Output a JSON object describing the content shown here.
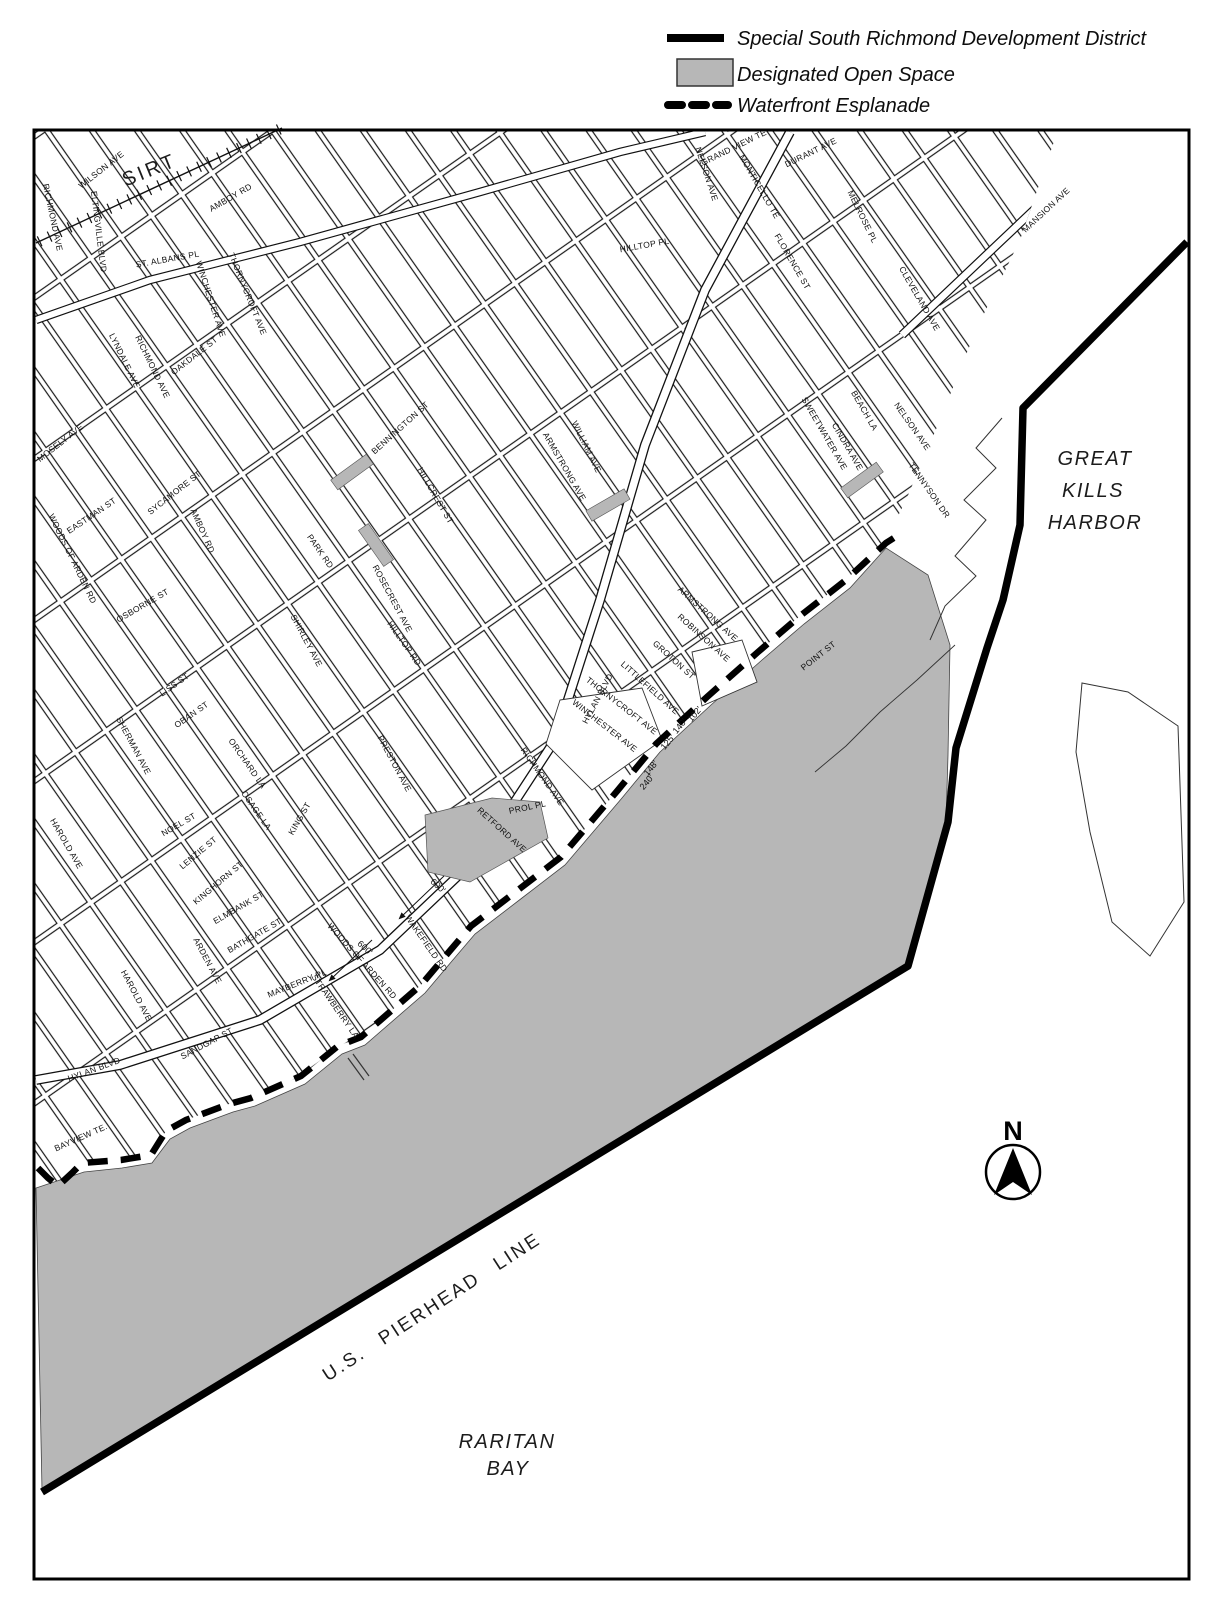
{
  "legend": {
    "items": [
      {
        "swatch": "solid-line",
        "label": "Special South Richmond Development District"
      },
      {
        "swatch": "gray-fill",
        "label": "Designated Open Space"
      },
      {
        "swatch": "dashed-line",
        "label": "Waterfront Esplanade"
      }
    ]
  },
  "map": {
    "colors": {
      "open_space": "#b7b7b7",
      "line": "#000000",
      "background": "#ffffff"
    },
    "region_labels": {
      "harbor": [
        "GREAT",
        "KILLS",
        "HARBOR"
      ],
      "bay": [
        "RARITAN",
        "BAY"
      ],
      "pierhead": "U.S. PIERHEAD LINE",
      "railroad": "SIRT",
      "compass": "N"
    },
    "street_labels": [
      {
        "t": "WILSON AVE",
        "x": 103,
        "y": 172,
        "r": -38
      },
      {
        "t": "RICHMOND AVE",
        "x": 50,
        "y": 218,
        "r": 78
      },
      {
        "t": "ELTINGVILLE BLVD",
        "x": 96,
        "y": 232,
        "r": 83
      },
      {
        "t": "AMBOY RD",
        "x": 232,
        "y": 200,
        "r": -30
      },
      {
        "t": "ST. ALBANS PL",
        "x": 168,
        "y": 262,
        "r": -10
      },
      {
        "t": "MOSELY AVE",
        "x": 62,
        "y": 445,
        "r": -38
      },
      {
        "t": "AMBOY RD",
        "x": 200,
        "y": 532,
        "r": 66
      },
      {
        "t": "LYNDALE AVE",
        "x": 122,
        "y": 362,
        "r": 64
      },
      {
        "t": "RICHMOND AVE",
        "x": 150,
        "y": 368,
        "r": 64
      },
      {
        "t": "THORNYCROFT AVE",
        "x": 245,
        "y": 295,
        "r": 68
      },
      {
        "t": "OAKDALE ST",
        "x": 196,
        "y": 358,
        "r": -38
      },
      {
        "t": "WINCHESTER AVE",
        "x": 208,
        "y": 300,
        "r": 72
      },
      {
        "t": "SYCAMORE ST",
        "x": 176,
        "y": 495,
        "r": -38
      },
      {
        "t": "EASTMAN ST",
        "x": 93,
        "y": 518,
        "r": -34
      },
      {
        "t": "WOODS OF ARDEN RD",
        "x": 70,
        "y": 560,
        "r": 64,
        "s": 10
      },
      {
        "t": "OSBORNE ST",
        "x": 144,
        "y": 608,
        "r": -30
      },
      {
        "t": "SHIRLEY AVE",
        "x": 304,
        "y": 642,
        "r": 62
      },
      {
        "t": "PARK RD",
        "x": 318,
        "y": 553,
        "r": 55
      },
      {
        "t": "BENNINGTON ST",
        "x": 402,
        "y": 430,
        "r": -42
      },
      {
        "t": "HILLCREST ST",
        "x": 433,
        "y": 497,
        "r": 60
      },
      {
        "t": "ARMSTRONG AVE",
        "x": 562,
        "y": 468,
        "r": 60
      },
      {
        "t": "WILLIAM AVE",
        "x": 584,
        "y": 448,
        "r": 64
      },
      {
        "t": "ROSECREST AVE",
        "x": 390,
        "y": 600,
        "r": 62
      },
      {
        "t": "HILLTOP RD",
        "x": 402,
        "y": 645,
        "r": 55
      },
      {
        "t": "HYLAN BLVD",
        "x": 600,
        "y": 700,
        "r": -62,
        "s": 13,
        "ls": 1
      },
      {
        "t": "HILLTOP PL",
        "x": 645,
        "y": 248,
        "r": -10
      },
      {
        "t": "NELSON AVE",
        "x": 704,
        "y": 175,
        "r": 72
      },
      {
        "t": "GRAND VIEW TE",
        "x": 735,
        "y": 150,
        "r": -26
      },
      {
        "t": "DURANT AVE",
        "x": 812,
        "y": 155,
        "r": -26
      },
      {
        "t": "MONTICELLO TE",
        "x": 757,
        "y": 188,
        "r": 60
      },
      {
        "t": "MELROSE PL",
        "x": 860,
        "y": 218,
        "r": 64
      },
      {
        "t": "FLORENCE ST",
        "x": 790,
        "y": 263,
        "r": 60
      },
      {
        "t": "CLEVELAND AVE",
        "x": 917,
        "y": 300,
        "r": 60
      },
      {
        "t": "MANSION AVE",
        "x": 1048,
        "y": 212,
        "r": -43,
        "s": 15,
        "ls": 4
      },
      {
        "t": "SWEETWATER AVE",
        "x": 822,
        "y": 435,
        "r": 60
      },
      {
        "t": "BEACH LA",
        "x": 862,
        "y": 412,
        "r": 60
      },
      {
        "t": "CINDRA AVE",
        "x": 845,
        "y": 448,
        "r": 60
      },
      {
        "t": "NELSON AVE",
        "x": 910,
        "y": 428,
        "r": 55
      },
      {
        "t": "TENNYSON DR",
        "x": 927,
        "y": 492,
        "r": 55
      },
      {
        "t": "POINT ST",
        "x": 820,
        "y": 658,
        "r": -38
      },
      {
        "t": "ROBINSON AVE",
        "x": 702,
        "y": 640,
        "r": 42
      },
      {
        "t": "GROTON ST",
        "x": 672,
        "y": 662,
        "r": 42
      },
      {
        "t": "LITTLEFIELD AVE",
        "x": 648,
        "y": 690,
        "r": 42
      },
      {
        "t": "ARMSTRONG AVE",
        "x": 706,
        "y": 616,
        "r": 42
      },
      {
        "t": "THORNYCROFT AVE",
        "x": 620,
        "y": 708,
        "r": 38
      },
      {
        "t": "WINCHESTER AVE",
        "x": 603,
        "y": 728,
        "r": 38
      },
      {
        "t": "RICHMOND AVE",
        "x": 540,
        "y": 778,
        "r": 55,
        "s": 11,
        "ls": 2
      },
      {
        "t": "PROL PL",
        "x": 528,
        "y": 810,
        "r": -12
      },
      {
        "t": "RETFORD AVE",
        "x": 500,
        "y": 832,
        "r": 42
      },
      {
        "t": "PRESTON AVE",
        "x": 392,
        "y": 765,
        "r": 62
      },
      {
        "t": "KING ST",
        "x": 302,
        "y": 820,
        "r": -60
      },
      {
        "t": "NOEL ST",
        "x": 180,
        "y": 827,
        "r": -30
      },
      {
        "t": "LENZIE ST",
        "x": 200,
        "y": 855,
        "r": -40
      },
      {
        "t": "KINGHORN ST",
        "x": 220,
        "y": 885,
        "r": -40
      },
      {
        "t": "ELMBANK ST",
        "x": 240,
        "y": 910,
        "r": -30
      },
      {
        "t": "BATHGATE ST",
        "x": 256,
        "y": 938,
        "r": -30
      },
      {
        "t": "ORCHARD LA",
        "x": 245,
        "y": 765,
        "r": 55
      },
      {
        "t": "OSAGE LA",
        "x": 254,
        "y": 812,
        "r": 55
      },
      {
        "t": "OBAN ST",
        "x": 193,
        "y": 717,
        "r": -35
      },
      {
        "t": "LISS ST",
        "x": 176,
        "y": 687,
        "r": -35
      },
      {
        "t": "SHERMAN AVE",
        "x": 131,
        "y": 747,
        "r": 62
      },
      {
        "t": "HAROLD AVE",
        "x": 64,
        "y": 845,
        "r": 60
      },
      {
        "t": "HAROLD AVE",
        "x": 134,
        "y": 997,
        "r": 62
      },
      {
        "t": "ARDEN AVE",
        "x": 205,
        "y": 962,
        "r": 62
      },
      {
        "t": "SANDGAP ST",
        "x": 208,
        "y": 1046,
        "r": -28
      },
      {
        "t": "HYLAN BLVD",
        "x": 95,
        "y": 1072,
        "r": -20,
        "s": 14,
        "ls": 1
      },
      {
        "t": "BAYVIEW TE.",
        "x": 82,
        "y": 1140,
        "r": -24
      },
      {
        "t": "MAYBERRY PL",
        "x": 298,
        "y": 986,
        "r": -22
      },
      {
        "t": "STRAWBERRY LA",
        "x": 333,
        "y": 1008,
        "r": 55
      },
      {
        "t": "WAKEFIELD RD",
        "x": 424,
        "y": 945,
        "r": 55
      },
      {
        "t": "WOODS OF ARDEN RD",
        "x": 360,
        "y": 963,
        "r": 48
      }
    ],
    "measurements": [
      {
        "t": "600'",
        "x": 436,
        "y": 888,
        "r": 42,
        "s": 10
      },
      {
        "t": "600'",
        "x": 363,
        "y": 950,
        "r": 42,
        "s": 10
      },
      {
        "t": "102'",
        "x": 697,
        "y": 716,
        "r": -50,
        "s": 8
      },
      {
        "t": "140'",
        "x": 682,
        "y": 728,
        "r": -50,
        "s": 8
      },
      {
        "t": "125'",
        "x": 670,
        "y": 744,
        "r": -50,
        "s": 8
      },
      {
        "t": "148'",
        "x": 653,
        "y": 770,
        "r": -50,
        "s": 8
      },
      {
        "t": "240'",
        "x": 649,
        "y": 784,
        "r": -50,
        "s": 8
      }
    ]
  }
}
